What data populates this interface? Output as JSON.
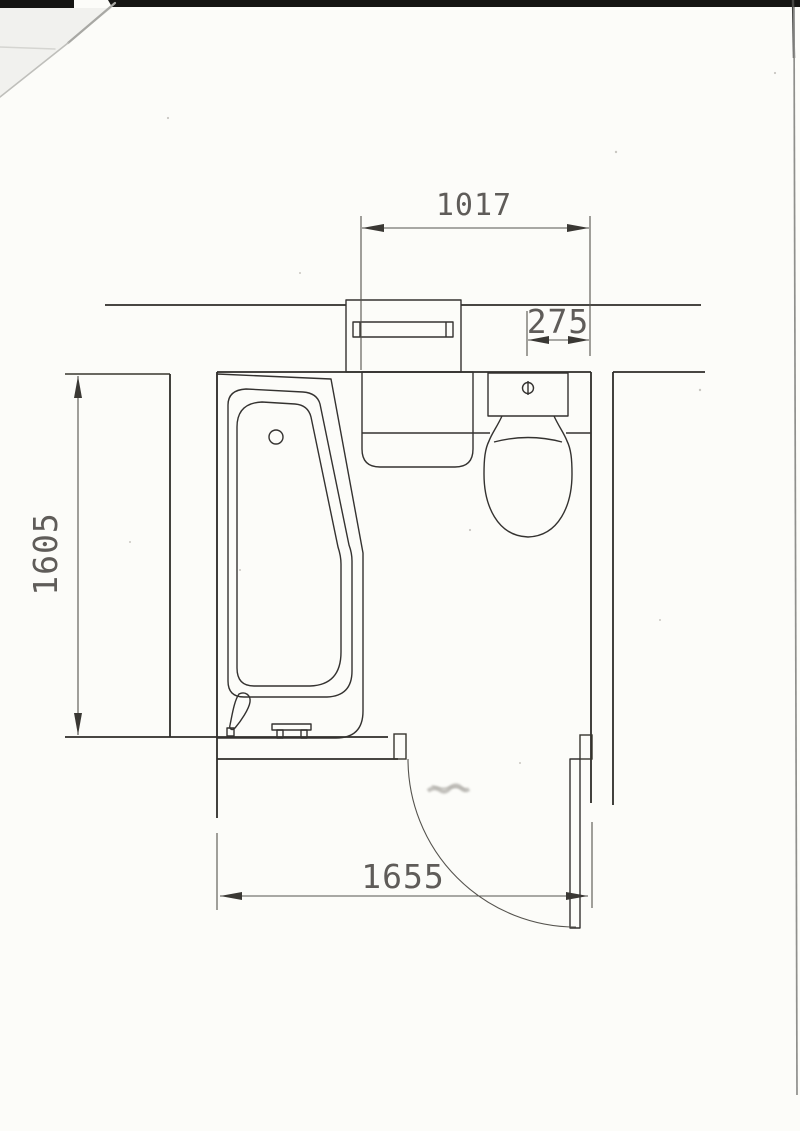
{
  "document": {
    "kind": "scanned bathroom floor plan",
    "colors": {
      "paper": "#fcfcf9",
      "ink": "#2e2c29",
      "dimension_ink": "#55534e",
      "scanner_band": "#151513",
      "page_edge_shadow": "#8f8f8c"
    }
  },
  "dimensions": {
    "top_width": "1017",
    "toilet_offset": "275",
    "room_depth": "1605",
    "bottom_width": "1655"
  }
}
